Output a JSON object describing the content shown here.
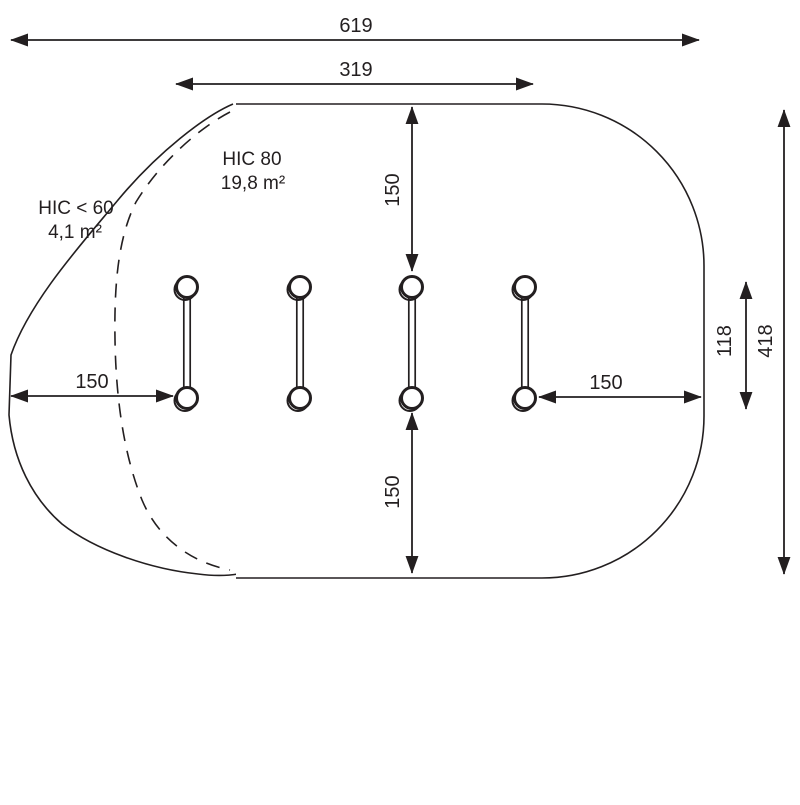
{
  "diagram": {
    "title_semantic": "safety-zone-footprint-diagram",
    "colors": {
      "line": "#231f20",
      "background": "#ffffff"
    },
    "zones": {
      "hic80_label": "HIC 80",
      "hic80_area": "19,8 m²",
      "hic60_label": "HIC < 60",
      "hic60_area": "4,1 m²"
    },
    "dimensions": {
      "total_width": "619",
      "item_width": "319",
      "clearance_top": "150",
      "clearance_bottom": "150",
      "clearance_left": "150",
      "clearance_right": "150",
      "item_depth": "118",
      "total_depth": "418"
    }
  }
}
